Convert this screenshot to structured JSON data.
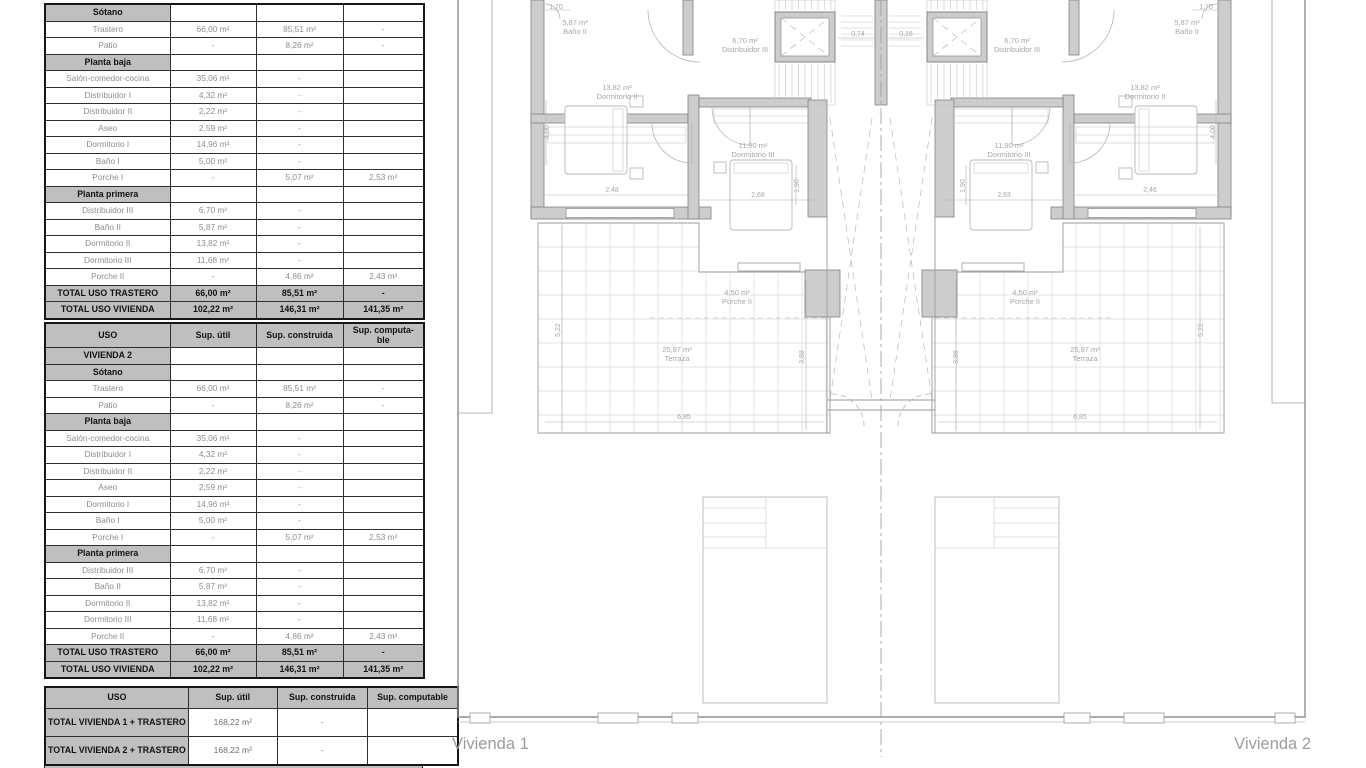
{
  "colors": {
    "table_header_bg": "#bfbfbf",
    "wall_gray": "#cdcdcd",
    "label_gray": "#a6a6a6"
  },
  "tables": {
    "column_headers": [
      "USO",
      "Sup. útil",
      "Sup. construida",
      [
        "Sup. computa-",
        "ble"
      ]
    ],
    "column_headers_bottom": [
      "USO",
      "Sup. útil",
      "Sup. construida",
      "Sup. computable"
    ],
    "table1": {
      "rows": [
        {
          "type": "section",
          "label": "Sótano"
        },
        {
          "type": "data",
          "label": "Trastero",
          "cells": [
            "66,00 m²",
            "85,51 m²",
            "-"
          ]
        },
        {
          "type": "data",
          "label": "Patio",
          "cells": [
            "-",
            "8,26 m²",
            "-"
          ]
        },
        {
          "type": "section",
          "label": "Planta baja"
        },
        {
          "type": "data",
          "label": "Salón-comedor-cocina",
          "cells": [
            "35,06 m²",
            "-",
            ""
          ]
        },
        {
          "type": "data",
          "label": "Distribuidor I",
          "cells": [
            "4,32 m²",
            "-",
            ""
          ]
        },
        {
          "type": "data",
          "label": "Distribuidor II",
          "cells": [
            "2,22 m²",
            "-",
            ""
          ]
        },
        {
          "type": "data",
          "label": "Aseo",
          "cells": [
            "2,59 m²",
            "-",
            ""
          ]
        },
        {
          "type": "data",
          "label": "Dormitorio I",
          "cells": [
            "14,96 m²",
            "-",
            ""
          ]
        },
        {
          "type": "data",
          "label": "Baño I",
          "cells": [
            "5,00 m²",
            "-",
            ""
          ]
        },
        {
          "type": "data",
          "label": "Porche I",
          "cells": [
            "-",
            "5,07 m²",
            "2,53 m²"
          ]
        },
        {
          "type": "section",
          "label": "Planta primera"
        },
        {
          "type": "data",
          "label": "Distribuidor III",
          "cells": [
            "6,70 m²",
            "-",
            ""
          ]
        },
        {
          "type": "data",
          "label": "Baño II",
          "cells": [
            "5,87 m²",
            "-",
            ""
          ]
        },
        {
          "type": "data",
          "label": "Dormitorio II",
          "cells": [
            "13,82 m²",
            "-",
            ""
          ]
        },
        {
          "type": "data",
          "label": "Dormitorio III",
          "cells": [
            "11,68 m²",
            "-",
            ""
          ]
        },
        {
          "type": "data",
          "label": "Porche II",
          "cells": [
            "-",
            "4,86 m²",
            "2,43 m²"
          ]
        },
        {
          "type": "total",
          "label": "TOTAL USO TRASTERO",
          "cells": [
            "66,00 m²",
            "85,51 m²",
            "-"
          ]
        },
        {
          "type": "total",
          "label": "TOTAL USO VIVIENDA",
          "cells": [
            "102,22 m²",
            "146,31 m²",
            "141,35 m²"
          ]
        }
      ]
    },
    "table2": {
      "rows": [
        {
          "type": "section",
          "label": "VIVIENDA 2"
        },
        {
          "type": "section",
          "label": "Sótano"
        },
        {
          "type": "data",
          "label": "Trastero",
          "cells": [
            "66,00 m²",
            "85,51 m²",
            "-"
          ]
        },
        {
          "type": "data",
          "label": "Patio",
          "cells": [
            "-",
            "8,26 m²",
            "-"
          ]
        },
        {
          "type": "section",
          "label": "Planta baja"
        },
        {
          "type": "data",
          "label": "Salón-comedor-cocina",
          "cells": [
            "35,06 m²",
            "-",
            ""
          ]
        },
        {
          "type": "data",
          "label": "Distribuidor I",
          "cells": [
            "4,32 m²",
            "-",
            ""
          ]
        },
        {
          "type": "data",
          "label": "Distribuidor II",
          "cells": [
            "2,22 m²",
            "-",
            ""
          ]
        },
        {
          "type": "data",
          "label": "Aseo",
          "cells": [
            "2,59 m²",
            "-",
            ""
          ]
        },
        {
          "type": "data",
          "label": "Dormitorio I",
          "cells": [
            "14,96 m²",
            "-",
            ""
          ]
        },
        {
          "type": "data",
          "label": "Baño I",
          "cells": [
            "5,00 m²",
            "-",
            ""
          ]
        },
        {
          "type": "data",
          "label": "Porche I",
          "cells": [
            "-",
            "5,07 m²",
            "2,53 m²"
          ]
        },
        {
          "type": "section",
          "label": "Planta primera"
        },
        {
          "type": "data",
          "label": "Distribuidor III",
          "cells": [
            "6,70 m²",
            "-",
            ""
          ]
        },
        {
          "type": "data",
          "label": "Baño II",
          "cells": [
            "5,87 m²",
            "-",
            ""
          ]
        },
        {
          "type": "data",
          "label": "Dormitorio II",
          "cells": [
            "13,82 m²",
            "-",
            ""
          ]
        },
        {
          "type": "data",
          "label": "Dormitorio III",
          "cells": [
            "11,68 m²",
            "-",
            ""
          ]
        },
        {
          "type": "data",
          "label": "Porche II",
          "cells": [
            "-",
            "4,86 m²",
            "2,43 m²"
          ]
        },
        {
          "type": "total",
          "label": "TOTAL USO TRASTERO",
          "cells": [
            "66,00 m²",
            "85,51 m²",
            "-"
          ]
        },
        {
          "type": "total",
          "label": "TOTAL USO VIVIENDA",
          "cells": [
            "102,22 m²",
            "146,31 m²",
            "141,35 m²"
          ]
        }
      ]
    },
    "table3": {
      "rows": [
        {
          "type": "total2",
          "label": "TOTAL VIVIENDA 1 + TRASTERO",
          "cells": [
            "168,22 m²",
            "-",
            ""
          ]
        },
        {
          "type": "total2",
          "label": "TOTAL VIVIENDA 2 + TRASTERO",
          "cells": [
            "168,22 m²",
            "-",
            ""
          ]
        }
      ]
    }
  },
  "plan": {
    "unit1_label": "Vivienda 1",
    "unit2_label": "Vivienda 2",
    "rooms_unit1": {
      "bano2_area": "5,87 m²",
      "bano2_name": "Baño II",
      "distribuidor3_area": "6,70 m²",
      "distribuidor3_name": "Distribuidor III",
      "dormitorio2_area": "13,82 m²",
      "dormitorio2_name": "Dormitorio II",
      "dormitorio3_area": "11,90 m²",
      "dormitorio3_name": "Dormitorio III",
      "porche2_area": "4,50 m²",
      "porche2_name": "Porche II",
      "terraza_area": "25,97 m²",
      "terraza_name": "Terraza"
    },
    "rooms_unit2": {
      "bano2_area": "5,87 m²",
      "bano2_name": "Baño II",
      "distribuidor3_area": "6,70 m²",
      "distribuidor3_name": "Distribuidor III",
      "dormitorio2_area": "13,82 m²",
      "dormitorio2_name": "Dormitorio II",
      "dormitorio3_area": "11,90 m²",
      "dormitorio3_name": "Dormitorio III",
      "porche2_area": "4,50 m²",
      "porche2_name": "Porche II",
      "terraza_area": "25,97 m²",
      "terraza_name": "Terraza"
    },
    "dims_unit1": {
      "top": "1,70",
      "wall_left": "4,00",
      "bed2": "2,48",
      "bed3": "2,68",
      "bed3_side": "1,90",
      "stair": "0,74",
      "terrace_left": "5,22",
      "terrace_right": "3,88",
      "terrace_bottom": "6,85"
    },
    "dims_unit2": {
      "top": "1,70",
      "wall_right": "4,00",
      "bed2": "2,46",
      "bed3": "2,93",
      "bed3_side": "1,90",
      "stair": "0,16",
      "terrace_left": "3,88",
      "terrace_right": "5,22",
      "terrace_bottom": "6,85"
    }
  }
}
